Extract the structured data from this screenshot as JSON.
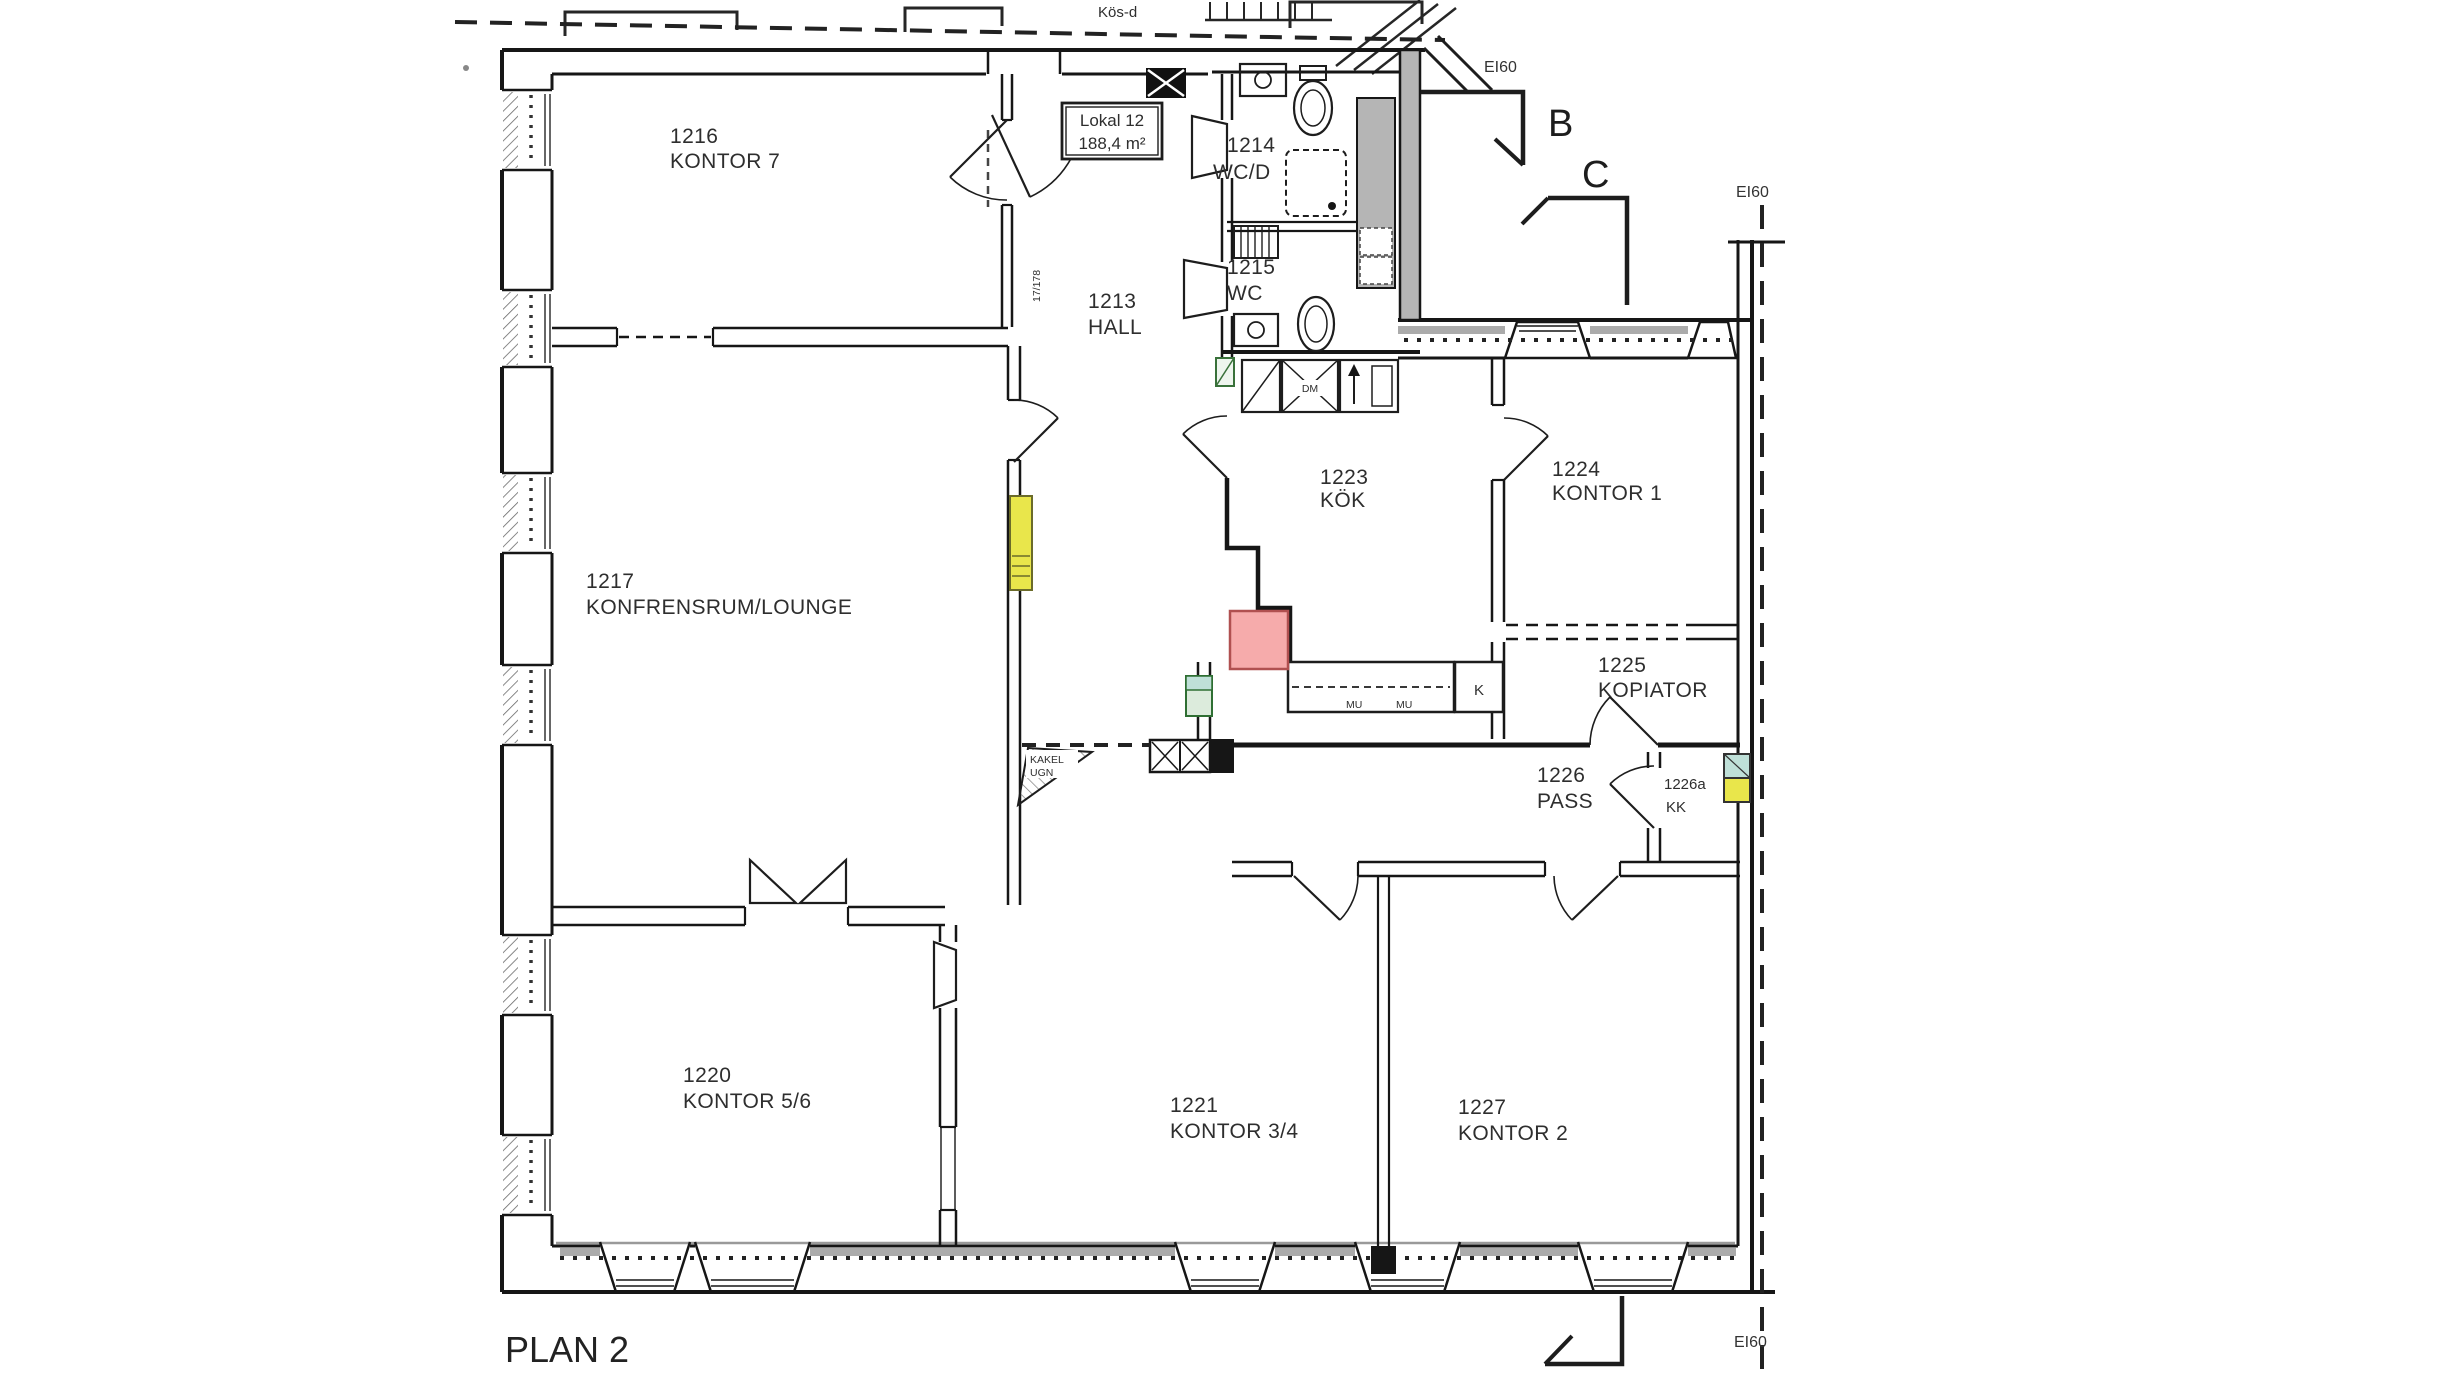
{
  "plan": {
    "title": "PLAN 2",
    "local_label": {
      "line1": "Lokal 12",
      "line2": "188,4 m²"
    },
    "rooms": [
      {
        "number": "1216",
        "name": "KONTOR 7"
      },
      {
        "number": "1217",
        "name": "KONFRENSRUM/LOUNGE"
      },
      {
        "number": "1220",
        "name": "KONTOR 5/6"
      },
      {
        "number": "1213",
        "name": "HALL"
      },
      {
        "number": "1214",
        "name": "WC/D"
      },
      {
        "number": "1215",
        "name": "WC"
      },
      {
        "number": "1223",
        "name": "KÖK"
      },
      {
        "number": "1224",
        "name": "KONTOR 1"
      },
      {
        "number": "1225",
        "name": "KOPIATOR"
      },
      {
        "number": "1226",
        "name": "PASS"
      },
      {
        "number": "1226a",
        "name": "KK"
      },
      {
        "number": "1221",
        "name": "KONTOR 3/4"
      },
      {
        "number": "1227",
        "name": "KONTOR 2"
      }
    ],
    "annotations": {
      "ei60": "EI60",
      "section_b": "B",
      "section_c": "C",
      "fridge": "K",
      "dishwasher": "DM",
      "counter_left": "MU",
      "counter_right": "MU",
      "stove_line1": "KAKEL",
      "stove_line2": "UGN",
      "stair_dim": "17/178",
      "top_cut_text": "Kös-d"
    },
    "colors": {
      "highlight_pink": "#f6abab",
      "highlight_yellow": "#e9e64b",
      "highlight_green": "#bfe0d8",
      "wall": "#161616"
    }
  }
}
